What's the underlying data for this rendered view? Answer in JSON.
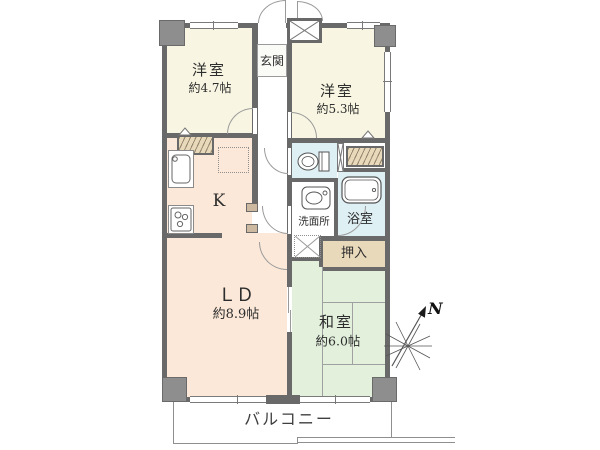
{
  "floor_plan": {
    "rooms": {
      "genkan": {
        "label": "玄関"
      },
      "western_room_left": {
        "label": "洋室",
        "size": "約4.7帖"
      },
      "western_room_right": {
        "label": "洋室",
        "size": "約5.3帖"
      },
      "kitchen": {
        "label": "K"
      },
      "washroom": {
        "label": "洗面所"
      },
      "bathroom": {
        "label": "浴室"
      },
      "closet": {
        "label": "押入"
      },
      "living_dining": {
        "label": "ＬＤ",
        "size": "約8.9帖"
      },
      "japanese_room": {
        "label": "和室",
        "size": "約6.0帖"
      },
      "balcony": {
        "label": "バルコニー"
      }
    },
    "compass": {
      "label": "N"
    },
    "colors": {
      "western_room": "#f8f6e2",
      "kitchen_living": "#fbe8d8",
      "japanese_room": "#e2f0dc",
      "wet_area": "#dff0f5",
      "storage": "#e9d9bb",
      "wall": "#696969"
    },
    "icons": {
      "compass": "compass-north-arrow",
      "toilet": "toilet-icon",
      "bathtub": "bathtub-icon",
      "washbasin": "washbasin-icon",
      "kitchen_sink": "kitchen-sink-icon",
      "stove": "stove-icon",
      "washing_machine": "washing-machine-space-icon",
      "meter_box": "meter-box-x-icon",
      "refrigerator": "refrigerator-space-dashed"
    }
  }
}
